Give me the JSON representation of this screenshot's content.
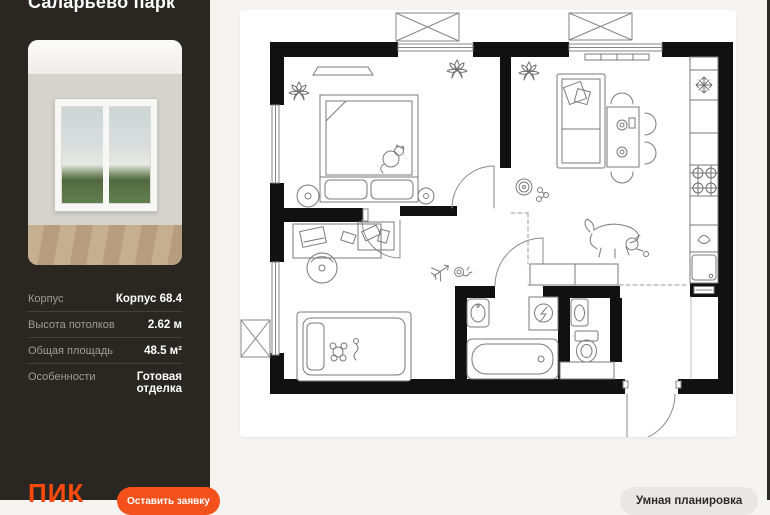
{
  "sidebar": {
    "project_title": "Саларьево парк",
    "specs": [
      {
        "label": "Корпус",
        "value": "Корпус 68.4"
      },
      {
        "label": "Высота потолков",
        "value": "2.62 м"
      },
      {
        "label": "Общая площадь",
        "value": "48.5 м²"
      },
      {
        "label": "Особенности",
        "value": "Готовая отделка"
      }
    ],
    "logo_text": "ПИК",
    "cta_label": "Оставить заявку"
  },
  "plan_panel": {
    "smart_layout_label": "Умная планировка"
  },
  "floor_plan": {
    "features": [
      "bedroom-double-bed",
      "nightstands",
      "cat",
      "plants",
      "kids-bed",
      "desk-with-chair",
      "sofa",
      "dining-table-with-chairs",
      "dog",
      "robot-vacuum",
      "kitchen-counter",
      "fridge-snowflake",
      "stove-burners",
      "kitchen-sink",
      "dishwasher",
      "bathtub",
      "bath-sink",
      "washing-machine",
      "toilet",
      "toilet-sink",
      "balcony-boxes",
      "entrance-door-arc",
      "kitchen-zone-dashed-line"
    ]
  },
  "colors": {
    "accent_orange": "#fb4a0e",
    "sidebar_bg": "#2a2723",
    "page_bg": "#f5f4f1",
    "card_bg": "#ffffff",
    "wall_black": "#111111",
    "smart_button_bg": "#e8e7e3"
  }
}
